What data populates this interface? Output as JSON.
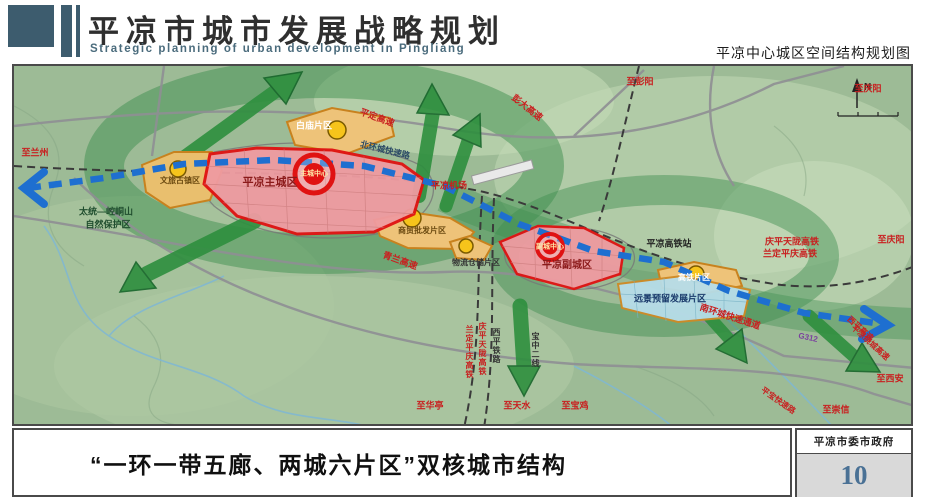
{
  "header": {
    "title": "平凉市城市发展战略规划",
    "subtitle": "Strategic planning of urban development in Pingliang",
    "caption": "平凉中心城区空间结构规划图"
  },
  "footer": {
    "slogan": "“一环一带五廊、两城六片区”双核城市结构",
    "authority": "平凉市委市政府",
    "page_number": "10"
  },
  "colors": {
    "header_accent": "#3d5c6e",
    "zone_red_border": "#e01212",
    "zone_red_fill": "#ef9ba1",
    "zone_orange_fill": "#eec379",
    "zone_orange_border": "#c8821e",
    "zone_blue_fill": "#b7dde9",
    "transit_blue": "#1e6fd0",
    "corridor_green": "#2e8f3e",
    "road_label_red": "#c82020",
    "page_number_blue": "#4a7195"
  },
  "map": {
    "compass": "N",
    "labels": [
      {
        "name": "label-to-lanzhou",
        "text": "至兰州",
        "x": 21,
        "y": 87,
        "size": 9,
        "color": "#c82020",
        "rot": 0,
        "vert": false
      },
      {
        "name": "label-pingding-expressway",
        "text": "平定高速",
        "x": 363,
        "y": 52,
        "size": 9,
        "color": "#c82020",
        "rot": 20,
        "vert": false
      },
      {
        "name": "label-pengda-expressway",
        "text": "彭大高速",
        "x": 513,
        "y": 42,
        "size": 9,
        "color": "#c82020",
        "rot": 38,
        "vert": false
      },
      {
        "name": "label-to-pengyang",
        "text": "至彭阳",
        "x": 626,
        "y": 16,
        "size": 9,
        "color": "#c82020",
        "rot": 0,
        "vert": false
      },
      {
        "name": "label-to-qingyang-top",
        "text": "至庆阳",
        "x": 854,
        "y": 23,
        "size": 9,
        "color": "#c82020",
        "rot": 0,
        "vert": false
      },
      {
        "name": "label-north-ring-road",
        "text": "北环城快速路",
        "x": 371,
        "y": 84,
        "size": 8.5,
        "color": "#2b4a66",
        "rot": 14,
        "vert": false
      },
      {
        "name": "label-pingliang-airport",
        "text": "平凉机场",
        "x": 435,
        "y": 120,
        "size": 9,
        "color": "#c82020",
        "rot": 0,
        "vert": false
      },
      {
        "name": "label-baimiao-district",
        "text": "白庙片区",
        "x": 300,
        "y": 60,
        "size": 9,
        "color": "#ffffff",
        "rot": 0,
        "vert": false
      },
      {
        "name": "label-main-city",
        "text": "平凉主城区",
        "x": 256,
        "y": 117,
        "size": 11,
        "color": "#8b1a1a",
        "rot": 0,
        "vert": false
      },
      {
        "name": "label-main-city-center",
        "text": "主城中心",
        "x": 300,
        "y": 108,
        "size": 7,
        "color": "#ffe9a8",
        "rot": 0,
        "vert": false
      },
      {
        "name": "label-culture-town-district",
        "text": "文旅古镇区",
        "x": 166,
        "y": 115,
        "size": 8,
        "color": "#6b4a10",
        "rot": 0,
        "vert": false
      },
      {
        "name": "label-nature-reserve-1",
        "text": "太统—崆峒山",
        "x": 92,
        "y": 146,
        "size": 9,
        "color": "#1f4d2e",
        "rot": 0,
        "vert": false
      },
      {
        "name": "label-nature-reserve-2",
        "text": "自然保护区",
        "x": 94,
        "y": 159,
        "size": 9,
        "color": "#1f4d2e",
        "rot": 0,
        "vert": false
      },
      {
        "name": "label-qinglan-expressway",
        "text": "青兰高速",
        "x": 386,
        "y": 195,
        "size": 9,
        "color": "#c82020",
        "rot": 20,
        "vert": false
      },
      {
        "name": "label-trade-district",
        "text": "商贸批发片区",
        "x": 408,
        "y": 165,
        "size": 8,
        "color": "#6b4a10",
        "rot": 0,
        "vert": false
      },
      {
        "name": "label-logistics-district",
        "text": "物流仓储片区",
        "x": 462,
        "y": 197,
        "size": 8,
        "color": "#333333",
        "rot": 0,
        "vert": false
      },
      {
        "name": "label-sub-city-center",
        "text": "副城中心",
        "x": 536,
        "y": 181,
        "size": 7,
        "color": "#ffe9a8",
        "rot": 0,
        "vert": false
      },
      {
        "name": "label-sub-city",
        "text": "平凉副城区",
        "x": 553,
        "y": 200,
        "size": 10,
        "color": "#8b1a1a",
        "rot": 0,
        "vert": false
      },
      {
        "name": "label-hsr-station",
        "text": "平凉高铁站",
        "x": 655,
        "y": 178,
        "size": 9,
        "color": "#222222",
        "rot": 0,
        "vert": false
      },
      {
        "name": "label-hsr-district",
        "text": "高铁片区",
        "x": 680,
        "y": 212,
        "size": 8,
        "color": "#ffffff",
        "rot": 0,
        "vert": false
      },
      {
        "name": "label-reserved-district",
        "text": "远景预留发展片区",
        "x": 656,
        "y": 233,
        "size": 9,
        "color": "#1a3a6b",
        "rot": 0,
        "vert": false
      },
      {
        "name": "label-south-ring-road",
        "text": "南环城快速通道",
        "x": 716,
        "y": 251,
        "size": 9,
        "color": "#c82020",
        "rot": 18,
        "vert": false
      },
      {
        "name": "label-qptl-hsr",
        "text": "庆平天陇高铁",
        "x": 778,
        "y": 176,
        "size": 9,
        "color": "#c82020",
        "rot": 0,
        "vert": false
      },
      {
        "name": "label-ldpq-hsr",
        "text": "兰定平庆高铁",
        "x": 776,
        "y": 188,
        "size": 9,
        "color": "#c82020",
        "rot": 0,
        "vert": false
      },
      {
        "name": "label-to-qingyang-right",
        "text": "至庆阳",
        "x": 877,
        "y": 174,
        "size": 9,
        "color": "#c82020",
        "rot": 0,
        "vert": false
      },
      {
        "name": "label-g312",
        "text": "G312",
        "x": 794,
        "y": 272,
        "size": 8,
        "color": "#7a3f9e",
        "rot": 12,
        "vert": false
      },
      {
        "name": "label-xiping-expressway",
        "text": "西平高速",
        "x": 846,
        "y": 263,
        "size": 8,
        "color": "#c82020",
        "rot": 42,
        "vert": false
      },
      {
        "name": "label-bypass-expressway",
        "text": "平凉绕城高速",
        "x": 856,
        "y": 277,
        "size": 8,
        "color": "#c82020",
        "rot": 42,
        "vert": false
      },
      {
        "name": "label-to-xian",
        "text": "至西安",
        "x": 876,
        "y": 313,
        "size": 9,
        "color": "#c82020",
        "rot": 0,
        "vert": false
      },
      {
        "name": "label-pingbao-expressroad",
        "text": "平宝快速路",
        "x": 764,
        "y": 335,
        "size": 8,
        "color": "#c82020",
        "rot": 35,
        "vert": false
      },
      {
        "name": "label-to-chongxin",
        "text": "至崇信",
        "x": 822,
        "y": 344,
        "size": 9,
        "color": "#c82020",
        "rot": 0,
        "vert": false
      },
      {
        "name": "label-to-huating",
        "text": "至华亭",
        "x": 416,
        "y": 340,
        "size": 9,
        "color": "#c82020",
        "rot": 0,
        "vert": false
      },
      {
        "name": "label-to-tianshui",
        "text": "至天水",
        "x": 503,
        "y": 340,
        "size": 9,
        "color": "#c82020",
        "rot": 0,
        "vert": false
      },
      {
        "name": "label-to-baoji",
        "text": "至宝鸡",
        "x": 561,
        "y": 340,
        "size": 9,
        "color": "#c82020",
        "rot": 0,
        "vert": false
      },
      {
        "name": "label-ldpq-hsr-vertical",
        "text": "兰定平庆高铁",
        "x": 455,
        "y": 286,
        "size": 8,
        "color": "#c82020",
        "rot": 0,
        "vert": true
      },
      {
        "name": "label-qptl-hsr-vertical",
        "text": "庆平天陇高铁",
        "x": 468,
        "y": 283,
        "size": 8,
        "color": "#c82020",
        "rot": 0,
        "vert": true
      },
      {
        "name": "label-xiping-railway",
        "text": "西平铁路",
        "x": 482,
        "y": 280,
        "size": 8,
        "color": "#333333",
        "rot": 0,
        "vert": true
      },
      {
        "name": "label-baozhong-railway",
        "text": "宝中二线",
        "x": 521,
        "y": 284,
        "size": 8,
        "color": "#333333",
        "rot": 0,
        "vert": true
      }
    ]
  }
}
